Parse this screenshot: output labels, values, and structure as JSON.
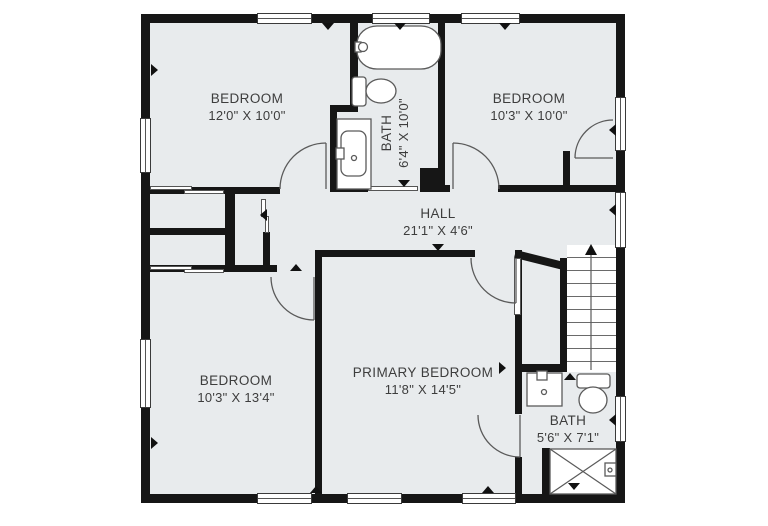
{
  "plan": {
    "title": "Second floor plan",
    "rooms": [
      {
        "id": "bedroom-top-left",
        "name": "BEDROOM",
        "dims": "12'0\" X 10'0\""
      },
      {
        "id": "bath-top",
        "name": "BATH",
        "dims": "6'4\" X 10'0\""
      },
      {
        "id": "bedroom-top-right",
        "name": "BEDROOM",
        "dims": "10'3\" X 10'0\""
      },
      {
        "id": "hall",
        "name": "HALL",
        "dims": "21'1\" X 4'6\""
      },
      {
        "id": "bedroom-bottom-left",
        "name": "BEDROOM",
        "dims": "10'3\" X 13'4\""
      },
      {
        "id": "primary-bedroom",
        "name": "PRIMARY BEDROOM",
        "dims": "11'8\" X 14'5\""
      },
      {
        "id": "bath-bottom",
        "name": "BATH",
        "dims": "5'6\" X 7'1\""
      }
    ],
    "fixtures": [
      "bathtub",
      "toilet",
      "sink-vanity",
      "shower",
      "staircase",
      "closet"
    ],
    "colors": {
      "floor": "#E8EBED",
      "wall": "#161616",
      "background": "#FFFFFF",
      "fixture_outline": "#5A5A5A",
      "text": "#3D3D3D"
    }
  }
}
